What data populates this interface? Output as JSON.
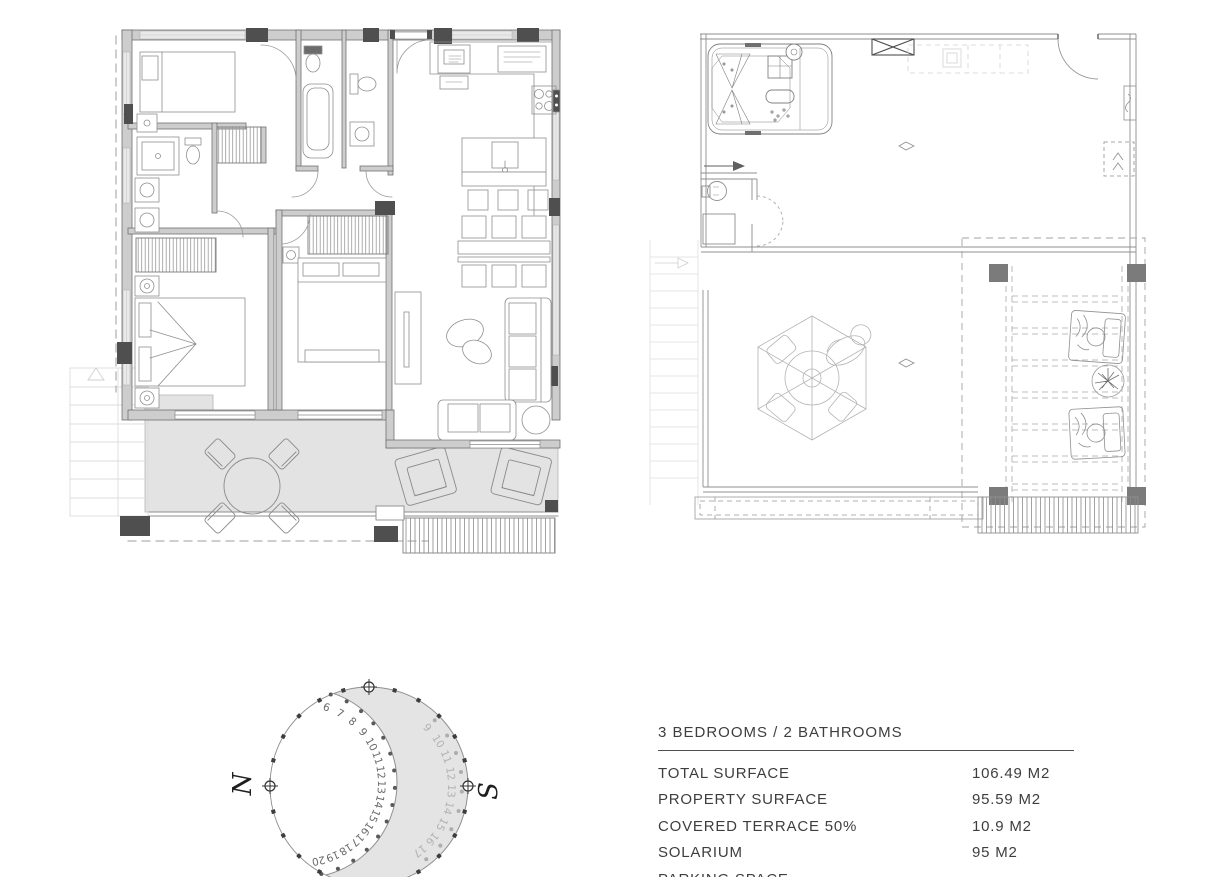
{
  "specs": {
    "header": "3 BEDROOMS / 2 BATHROOMS",
    "rows": [
      {
        "label": "TOTAL SURFACE",
        "value": "106.49 M2"
      },
      {
        "label": "PROPERTY SURFACE",
        "value": "95.59 M2"
      },
      {
        "label": "COVERED TERRACE 50%",
        "value": "10.9 M2"
      },
      {
        "label": "SOLARIUM",
        "value": "95 M2"
      },
      {
        "label": "PARKING SPACE",
        "value": ""
      }
    ]
  },
  "compass": {
    "north_label": "N",
    "south_label": "S",
    "inner_hour_labels": [
      "6",
      "7",
      "8",
      "9",
      "10",
      "11",
      "12",
      "13",
      "14",
      "15",
      "16",
      "17",
      "18",
      "19",
      "20"
    ],
    "outer_hour_labels": [
      "9",
      "10",
      "11",
      "12",
      "13",
      "14",
      "15",
      "16",
      "17"
    ],
    "shade_color": "#e4e4e4",
    "dot_color": "#3d3d3d",
    "inner_number_color": "#6a6a6a",
    "outer_number_color": "#b2b2b2"
  },
  "colors": {
    "wall_fill": "#cdcdcd",
    "wall_edge": "#707070",
    "column_dark": "#4f4f4f",
    "terrace_fill": "#e3e3e3",
    "furniture_line": "#8f8f8f",
    "faint_line": "#d9d9d9",
    "text": "#3e3e3e"
  }
}
